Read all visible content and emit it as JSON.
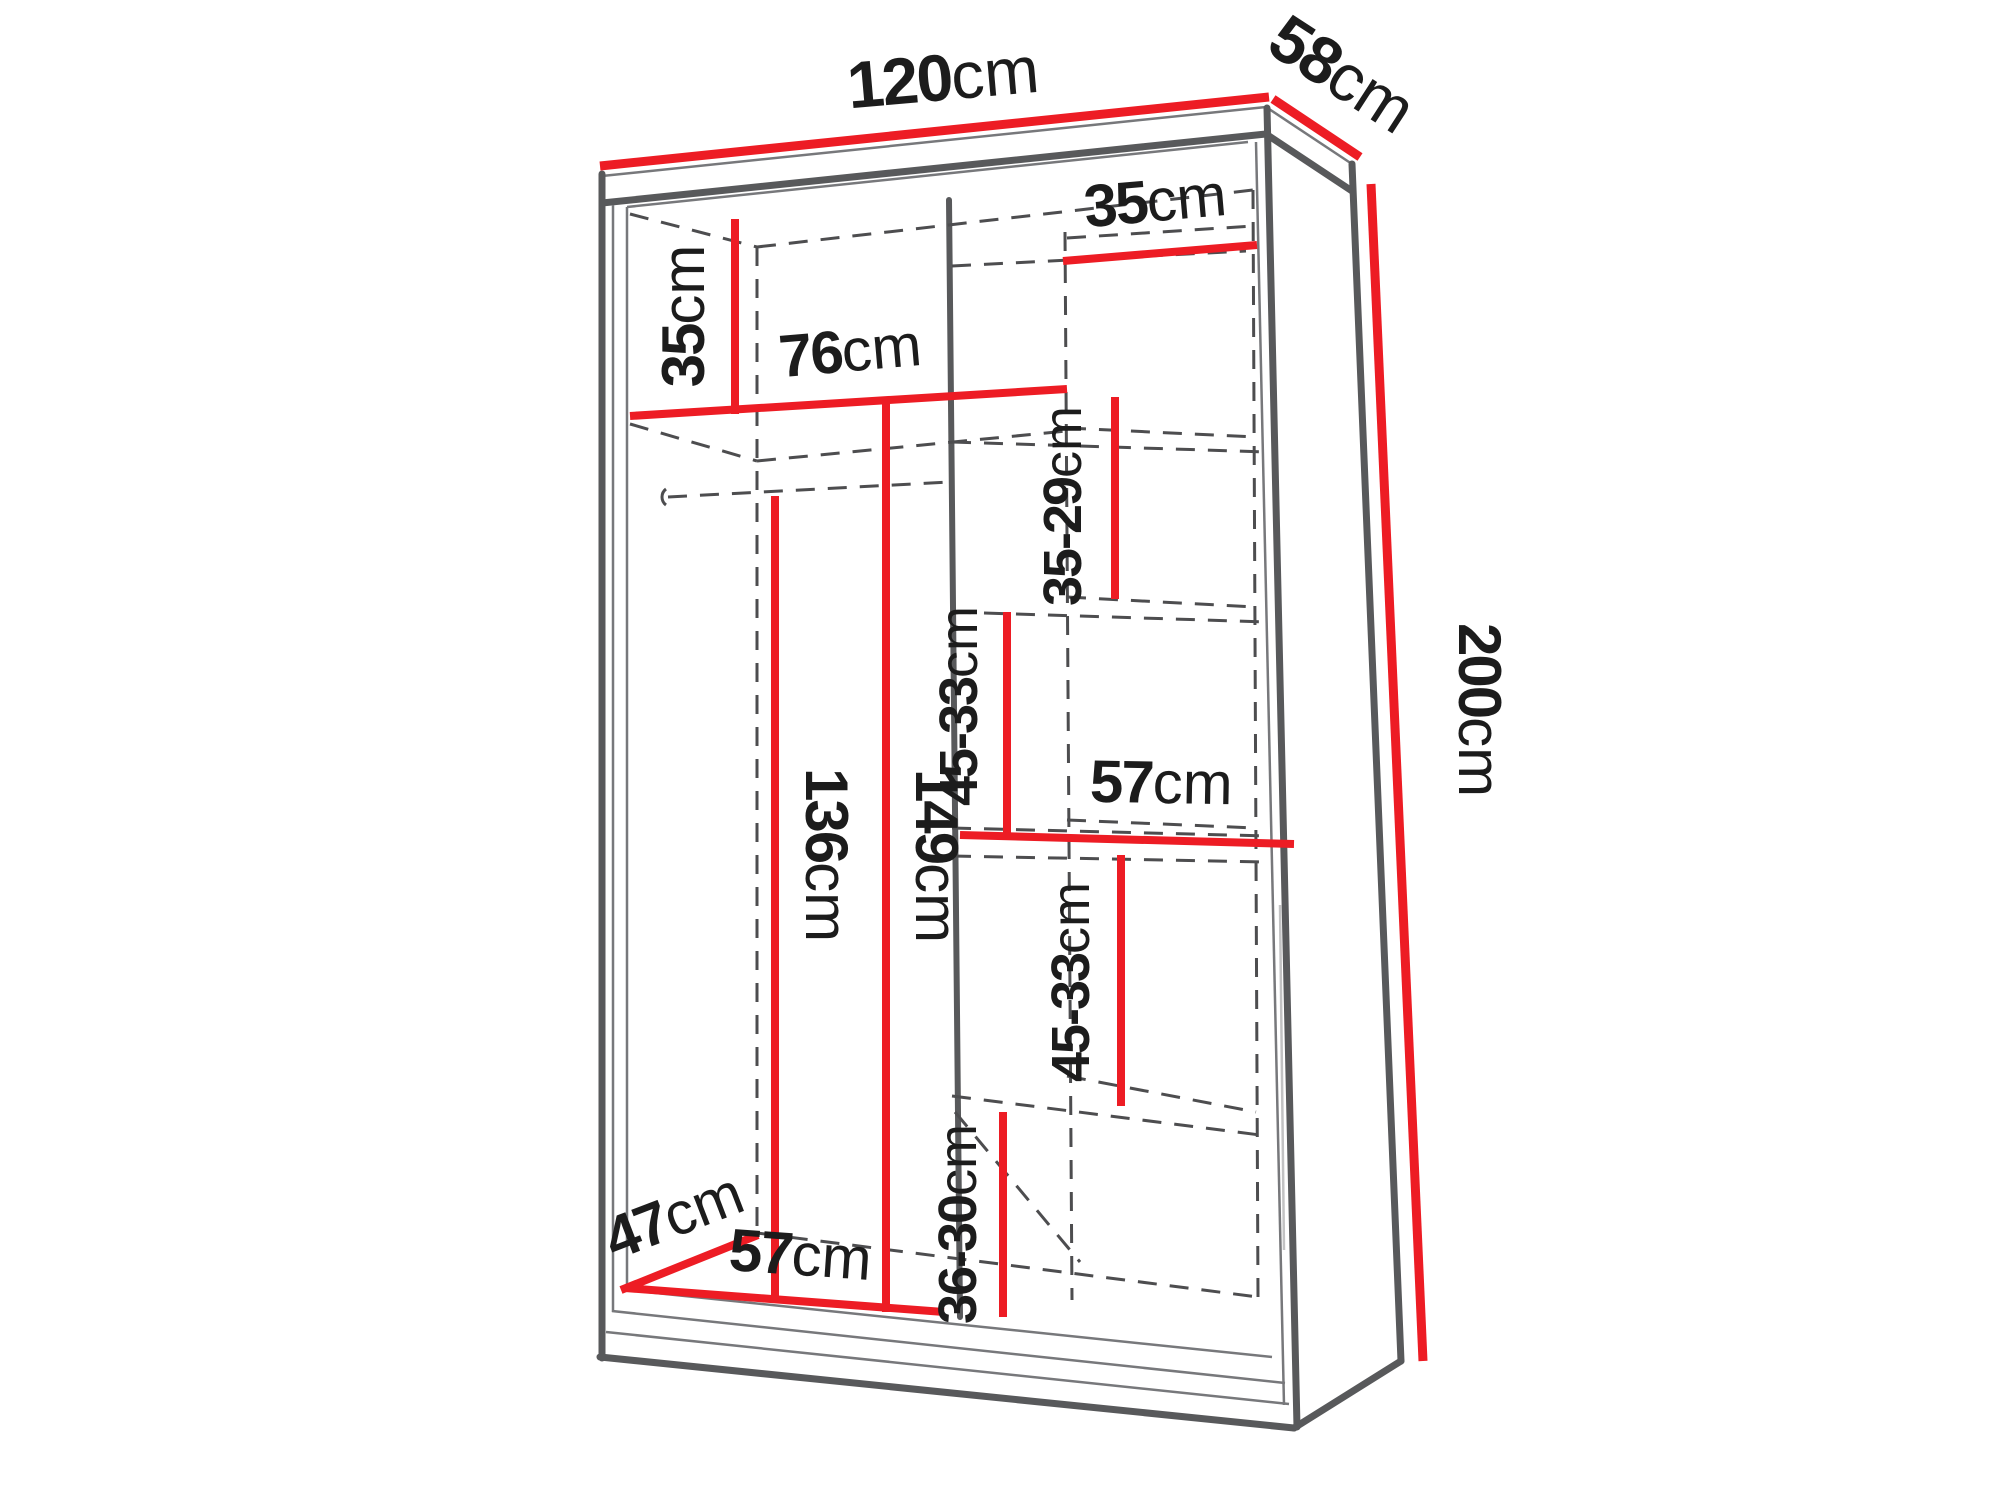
{
  "diagram": {
    "kind": "wardrobe-dimension-diagram",
    "unit": "cm",
    "colors": {
      "dimension_line": "#ed1c24",
      "outline": "#58595b",
      "hidden_line": "#4d4d4f",
      "text": "#1c1c1c"
    },
    "dims": {
      "width": {
        "num": "120",
        "unit": "cm"
      },
      "depth": {
        "num": "58",
        "unit": "cm"
      },
      "height": {
        "num": "200",
        "unit": "cm"
      },
      "top_left_cubby": {
        "num": "35",
        "unit": "cm"
      },
      "top_shelf_width": {
        "num": "76",
        "unit": "cm"
      },
      "right_col_width": {
        "num": "35",
        "unit": "cm"
      },
      "right_sec_1": {
        "num": "35-29",
        "unit": "cm"
      },
      "right_sec_2": {
        "num": "45-33",
        "unit": "cm"
      },
      "right_shelf_width": {
        "num": "57",
        "unit": "cm"
      },
      "right_sec_3": {
        "num": "45-33",
        "unit": "cm"
      },
      "right_sec_4": {
        "num": "36-30",
        "unit": "cm"
      },
      "rail_height": {
        "num": "136",
        "unit": "cm"
      },
      "left_sec_height": {
        "num": "149",
        "unit": "cm"
      },
      "floor_depth": {
        "num": "47",
        "unit": "cm"
      },
      "left_col_width": {
        "num": "57",
        "unit": "cm"
      }
    }
  }
}
